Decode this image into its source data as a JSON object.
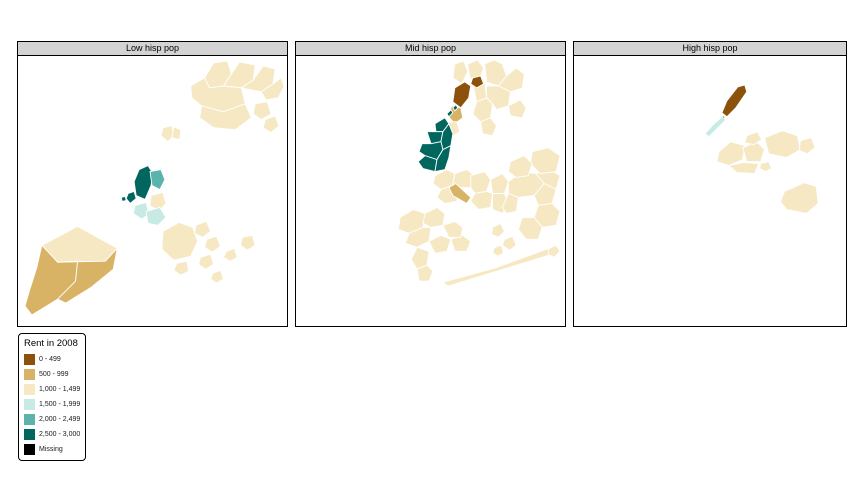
{
  "legend": {
    "title": "Rent in 2008",
    "items": [
      {
        "label": "0 - 499",
        "color": "#8c510a"
      },
      {
        "label": "500 - 999",
        "color": "#d8b365"
      },
      {
        "label": "1,000 - 1,499",
        "color": "#f6e8c3"
      },
      {
        "label": "1,500 - 1,999",
        "color": "#c7eae5"
      },
      {
        "label": "2,000 - 2,499",
        "color": "#5ab4ac"
      },
      {
        "label": "2,500 - 3,000",
        "color": "#01665e"
      },
      {
        "label": "Missing",
        "color": "#000000"
      }
    ]
  },
  "chart_data": {
    "type": "choropleth",
    "title": "Rent in 2008",
    "legend_position": "bottom-left",
    "facets": [
      {
        "label": "Low hisp pop",
        "regions": [
          {
            "band": "1,000 - 1,499",
            "points": "188,22 197,7 211,5 215,18 207,30 193,32"
          },
          {
            "band": "1,000 - 1,499",
            "points": "215,18 223,6 239,9 237,24 225,32 207,30"
          },
          {
            "band": "1,000 - 1,499",
            "points": "237,24 247,10 259,13 257,28 245,36 225,32"
          },
          {
            "band": "1,000 - 1,499",
            "points": "257,28 265,22 268,31 262,42 250,44 245,36"
          },
          {
            "band": "1,000 - 1,499",
            "points": "174,30 188,22 193,32 207,30 225,32 229,48 207,56 185,50 175,42"
          },
          {
            "band": "1,000 - 1,499",
            "points": "185,50 207,56 229,48 235,62 219,74 197,72 183,62"
          },
          {
            "band": "1,000 - 1,499",
            "points": "239,48 251,46 255,58 245,64 237,58"
          },
          {
            "band": "1,000 - 1,499",
            "points": "249,64 259,60 263,70 255,77 247,72"
          },
          {
            "band": "1,000 - 1,499",
            "points": "146,72 155,70 157,80 151,86 144,80"
          },
          {
            "band": "1,000 - 1,499",
            "points": "157,71 164,74 163,84 155,82"
          },
          {
            "band": "2,500 - 3,000",
            "points": "122,114 131,110 136,118 134,130 128,144 119,140 117,126"
          },
          {
            "band": "2,500 - 3,000",
            "points": "111,138 117,136 119,143 113,148 109,143"
          },
          {
            "band": "2,500 - 3,000",
            "points": "104,142 108,141 109,145 105,146"
          },
          {
            "band": "2,000 - 2,499",
            "points": "133,116 144,114 148,124 143,134 135,130"
          },
          {
            "band": "1,000 - 1,499",
            "points": "134,140 146,137 149,148 142,156 133,150"
          },
          {
            "band": "1,500 - 1,999",
            "points": "118,150 129,147 132,158 125,164 116,158"
          },
          {
            "band": "1,500 - 1,999",
            "points": "129,156 143,152 149,162 141,170 131,168"
          },
          {
            "band": "1,000 - 1,499",
            "points": "146,176 162,167 176,172 181,186 174,201 157,205 145,194"
          },
          {
            "band": "1,000 - 1,499",
            "points": "179,170 190,166 194,176 186,182 178,178"
          },
          {
            "band": "1,000 - 1,499",
            "points": "190,184 200,181 204,191 196,197 188,192"
          },
          {
            "band": "1,000 - 1,499",
            "points": "184,202 194,199 197,209 189,214 182,209"
          },
          {
            "band": "1,000 - 1,499",
            "points": "160,208 170,206 172,216 164,220 157,215"
          },
          {
            "band": "1,000 - 1,499",
            "points": "226,182 236,180 239,190 231,195 224,190"
          },
          {
            "band": "1,000 - 1,499",
            "points": "196,218 204,215 207,224 200,228 194,224"
          },
          {
            "band": "1,000 - 1,499",
            "points": "210,196 218,193 221,202 214,206 207,202"
          },
          {
            "band": "1,000 - 1,499",
            "points": "24,190 60,171 100,193 88,206 40,207"
          },
          {
            "band": "500 - 999",
            "points": "24,190 40,207 60,206 58,226 40,244 14,260 7,251 12,234 19,212"
          },
          {
            "band": "500 - 999",
            "points": "40,207 88,206 100,193 96,214 74,232 48,248 40,244 58,226 60,206"
          }
        ]
      },
      {
        "label": "Mid hisp pop",
        "regions": [
          {
            "band": "1,000 - 1,499",
            "points": "160,8 169,5 173,16 167,28 158,22"
          },
          {
            "band": "1,000 - 1,499",
            "points": "173,8 183,4 189,12 185,24 175,22"
          },
          {
            "band": "1,000 - 1,499",
            "points": "190,8 200,4 208,8 212,20 204,30 192,26"
          },
          {
            "band": "1,000 - 1,499",
            "points": "212,20 222,12 230,18 228,32 216,36 204,30"
          },
          {
            "band": "1,000 - 1,499",
            "points": "178,28 190,26 192,42 182,46"
          },
          {
            "band": "0 - 499",
            "points": "178,22 186,20 189,28 182,32 176,28"
          },
          {
            "band": "0 - 499",
            "points": "160,32 170,26 176,30 174,42 166,52 158,46"
          },
          {
            "band": "500 - 999",
            "points": "157,50 166,52 168,62 160,68 153,60"
          },
          {
            "band": "1,000 - 1,499",
            "points": "152,66 162,66 165,76 157,81 149,76"
          },
          {
            "band": "1,000 - 1,499",
            "points": "182,46 192,42 198,48 196,62 186,66 178,58"
          },
          {
            "band": "1,000 - 1,499",
            "points": "192,30 204,30 216,36 214,50 202,54 198,48 192,42"
          },
          {
            "band": "1,000 - 1,499",
            "points": "214,50 226,44 232,52 228,62 216,60"
          },
          {
            "band": "1,000 - 1,499",
            "points": "186,66 196,62 202,70 198,80 188,78"
          },
          {
            "band": "2,500 - 3,000",
            "points": "140,68 150,62 154,68 148,76 141,76"
          },
          {
            "band": "2,500 - 3,000",
            "points": "132,76 141,76 148,76 146,86 136,88"
          },
          {
            "band": "2,500 - 3,000",
            "points": "146,86 148,76 154,68 158,78 156,90 148,94"
          },
          {
            "band": "2,500 - 3,000",
            "points": "127,88 136,88 146,86 148,94 142,104 130,100 124,96"
          },
          {
            "band": "2,500 - 3,000",
            "points": "130,100 142,104 140,116 128,113 123,106"
          },
          {
            "band": "2,500 - 3,000",
            "points": "142,104 148,94 156,90 154,102 150,114 140,116"
          },
          {
            "band": "2,500 - 3,000",
            "points": "152,58 156,54 158,57 154,61"
          },
          {
            "band": "2,500 - 3,000",
            "points": "158,52 161,49 163,52 160,55"
          },
          {
            "band": "1,000 - 1,499",
            "points": "140,120 152,114 160,118 158,130 146,134 138,128"
          },
          {
            "band": "1,000 - 1,499",
            "points": "160,118 172,114 180,120 176,132 164,132 158,130"
          },
          {
            "band": "1,000 - 1,499",
            "points": "146,134 158,130 164,132 162,146 150,148 142,142"
          },
          {
            "band": "500 - 999",
            "points": "154,132 161,128 176,142 172,148 158,140"
          },
          {
            "band": "1,000 - 1,499",
            "points": "176,120 190,116 196,124 192,136 180,138 176,132"
          },
          {
            "band": "1,000 - 1,499",
            "points": "196,124 208,118 214,126 210,138 198,138"
          },
          {
            "band": "1,000 - 1,499",
            "points": "180,138 192,136 198,138 196,152 184,154 176,146"
          },
          {
            "band": "1,000 - 1,499",
            "points": "198,138 210,138 214,148 208,158 198,154"
          },
          {
            "band": "1,000 - 1,499",
            "points": "214,126 228,116 242,118 250,128 240,140 224,142 214,138"
          },
          {
            "band": "1,000 - 1,499",
            "points": "242,118 256,114 266,120 262,134 250,128"
          },
          {
            "band": "1,000 - 1,499",
            "points": "250,128 262,134 258,148 244,150 240,140"
          },
          {
            "band": "1,000 - 1,499",
            "points": "214,138 224,142 222,156 212,158 208,152"
          },
          {
            "band": "1,000 - 1,499",
            "points": "238,96 254,92 266,100 262,116 246,118 236,108"
          },
          {
            "band": "1,000 - 1,499",
            "points": "216,106 230,100 238,108 234,120 222,122 214,116"
          },
          {
            "band": "1,000 - 1,499",
            "points": "105,162 118,154 130,158 128,172 114,178 103,174"
          },
          {
            "band": "1,000 - 1,499",
            "points": "130,158 142,152 150,158 148,170 136,172 128,168"
          },
          {
            "band": "1,000 - 1,499",
            "points": "114,178 128,172 136,172 134,186 122,192 110,188"
          },
          {
            "band": "1,000 - 1,499",
            "points": "134,186 146,180 156,184 152,196 140,198"
          },
          {
            "band": "1,000 - 1,499",
            "points": "122,192 134,196 132,210 122,214 116,204"
          },
          {
            "band": "1,000 - 1,499",
            "points": "122,214 132,210 138,216 134,226 124,226"
          },
          {
            "band": "1,000 - 1,499",
            "points": "156,184 168,180 176,186 172,196 160,196"
          },
          {
            "band": "1,000 - 1,499",
            "points": "148,170 160,166 168,172 166,182 154,182"
          },
          {
            "band": "1,000 - 1,499",
            "points": "244,150 258,148 266,156 262,170 248,172 240,162"
          },
          {
            "band": "1,000 - 1,499",
            "points": "228,162 240,162 248,172 244,184 232,184 224,174"
          },
          {
            "band": "1,000 - 1,499",
            "points": "198,172 206,168 210,176 204,182 197,179"
          },
          {
            "band": "1,000 - 1,499",
            "points": "210,184 218,181 222,190 215,195 208,190"
          },
          {
            "band": "1,000 - 1,499",
            "points": "200,192 207,190 209,198 203,201 198,197"
          },
          {
            "band": "1,000 - 1,499",
            "points": "148,227 153,231 258,199 255,193 200,213"
          },
          {
            "band": "1,000 - 1,499",
            "points": "255,193 262,190 266,196 260,202 254,199"
          }
        ]
      },
      {
        "label": "High hisp pop",
        "regions": [
          {
            "band": "0 - 499",
            "points": "149,57 154,45 165,31 172,29 174,36 163,52 154,61"
          },
          {
            "band": "0 - 499",
            "points": "147,62 151,60 153,64 149,66"
          },
          {
            "band": "1,500 - 1,999",
            "points": "132,78 136,81 153,64 149,61 140,69"
          },
          {
            "band": "1,000 - 1,499",
            "points": "146,96 158,86 172,90 170,104 156,110 144,106"
          },
          {
            "band": "1,000 - 1,499",
            "points": "170,92 184,86 192,94 188,106 174,106"
          },
          {
            "band": "1,000 - 1,499",
            "points": "174,80 185,76 189,84 181,89 172,87"
          },
          {
            "band": "1,000 - 1,499",
            "points": "192,82 210,75 225,80 228,94 214,102 196,98"
          },
          {
            "band": "1,000 - 1,499",
            "points": "228,85 239,82 243,92 235,98 227,95"
          },
          {
            "band": "1,000 - 1,499",
            "points": "156,110 170,107 186,108 182,118 164,117"
          },
          {
            "band": "1,000 - 1,499",
            "points": "188,108 196,106 199,113 193,116 187,113"
          },
          {
            "band": "1,000 - 1,499",
            "points": "212,136 232,127 244,131 246,148 234,158 214,154 208,146"
          }
        ]
      }
    ]
  }
}
